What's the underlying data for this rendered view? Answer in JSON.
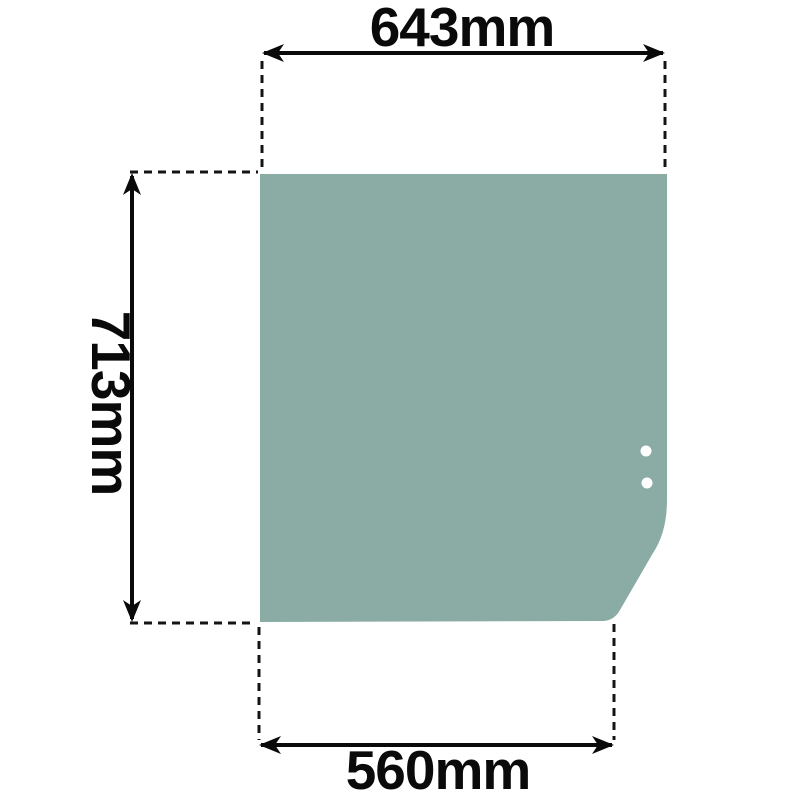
{
  "drawing": {
    "kind": "technical-dimension-drawing",
    "background_color": "#ffffff",
    "colors": {
      "glass": "#8AACA5",
      "line": "#0a0a0a",
      "hole": "#ffffff"
    },
    "dimensions": {
      "top": {
        "label": "643mm"
      },
      "left": {
        "label": "713mm"
      },
      "bottom": {
        "label": "560mm"
      }
    },
    "holes": {
      "count": 2
    }
  }
}
